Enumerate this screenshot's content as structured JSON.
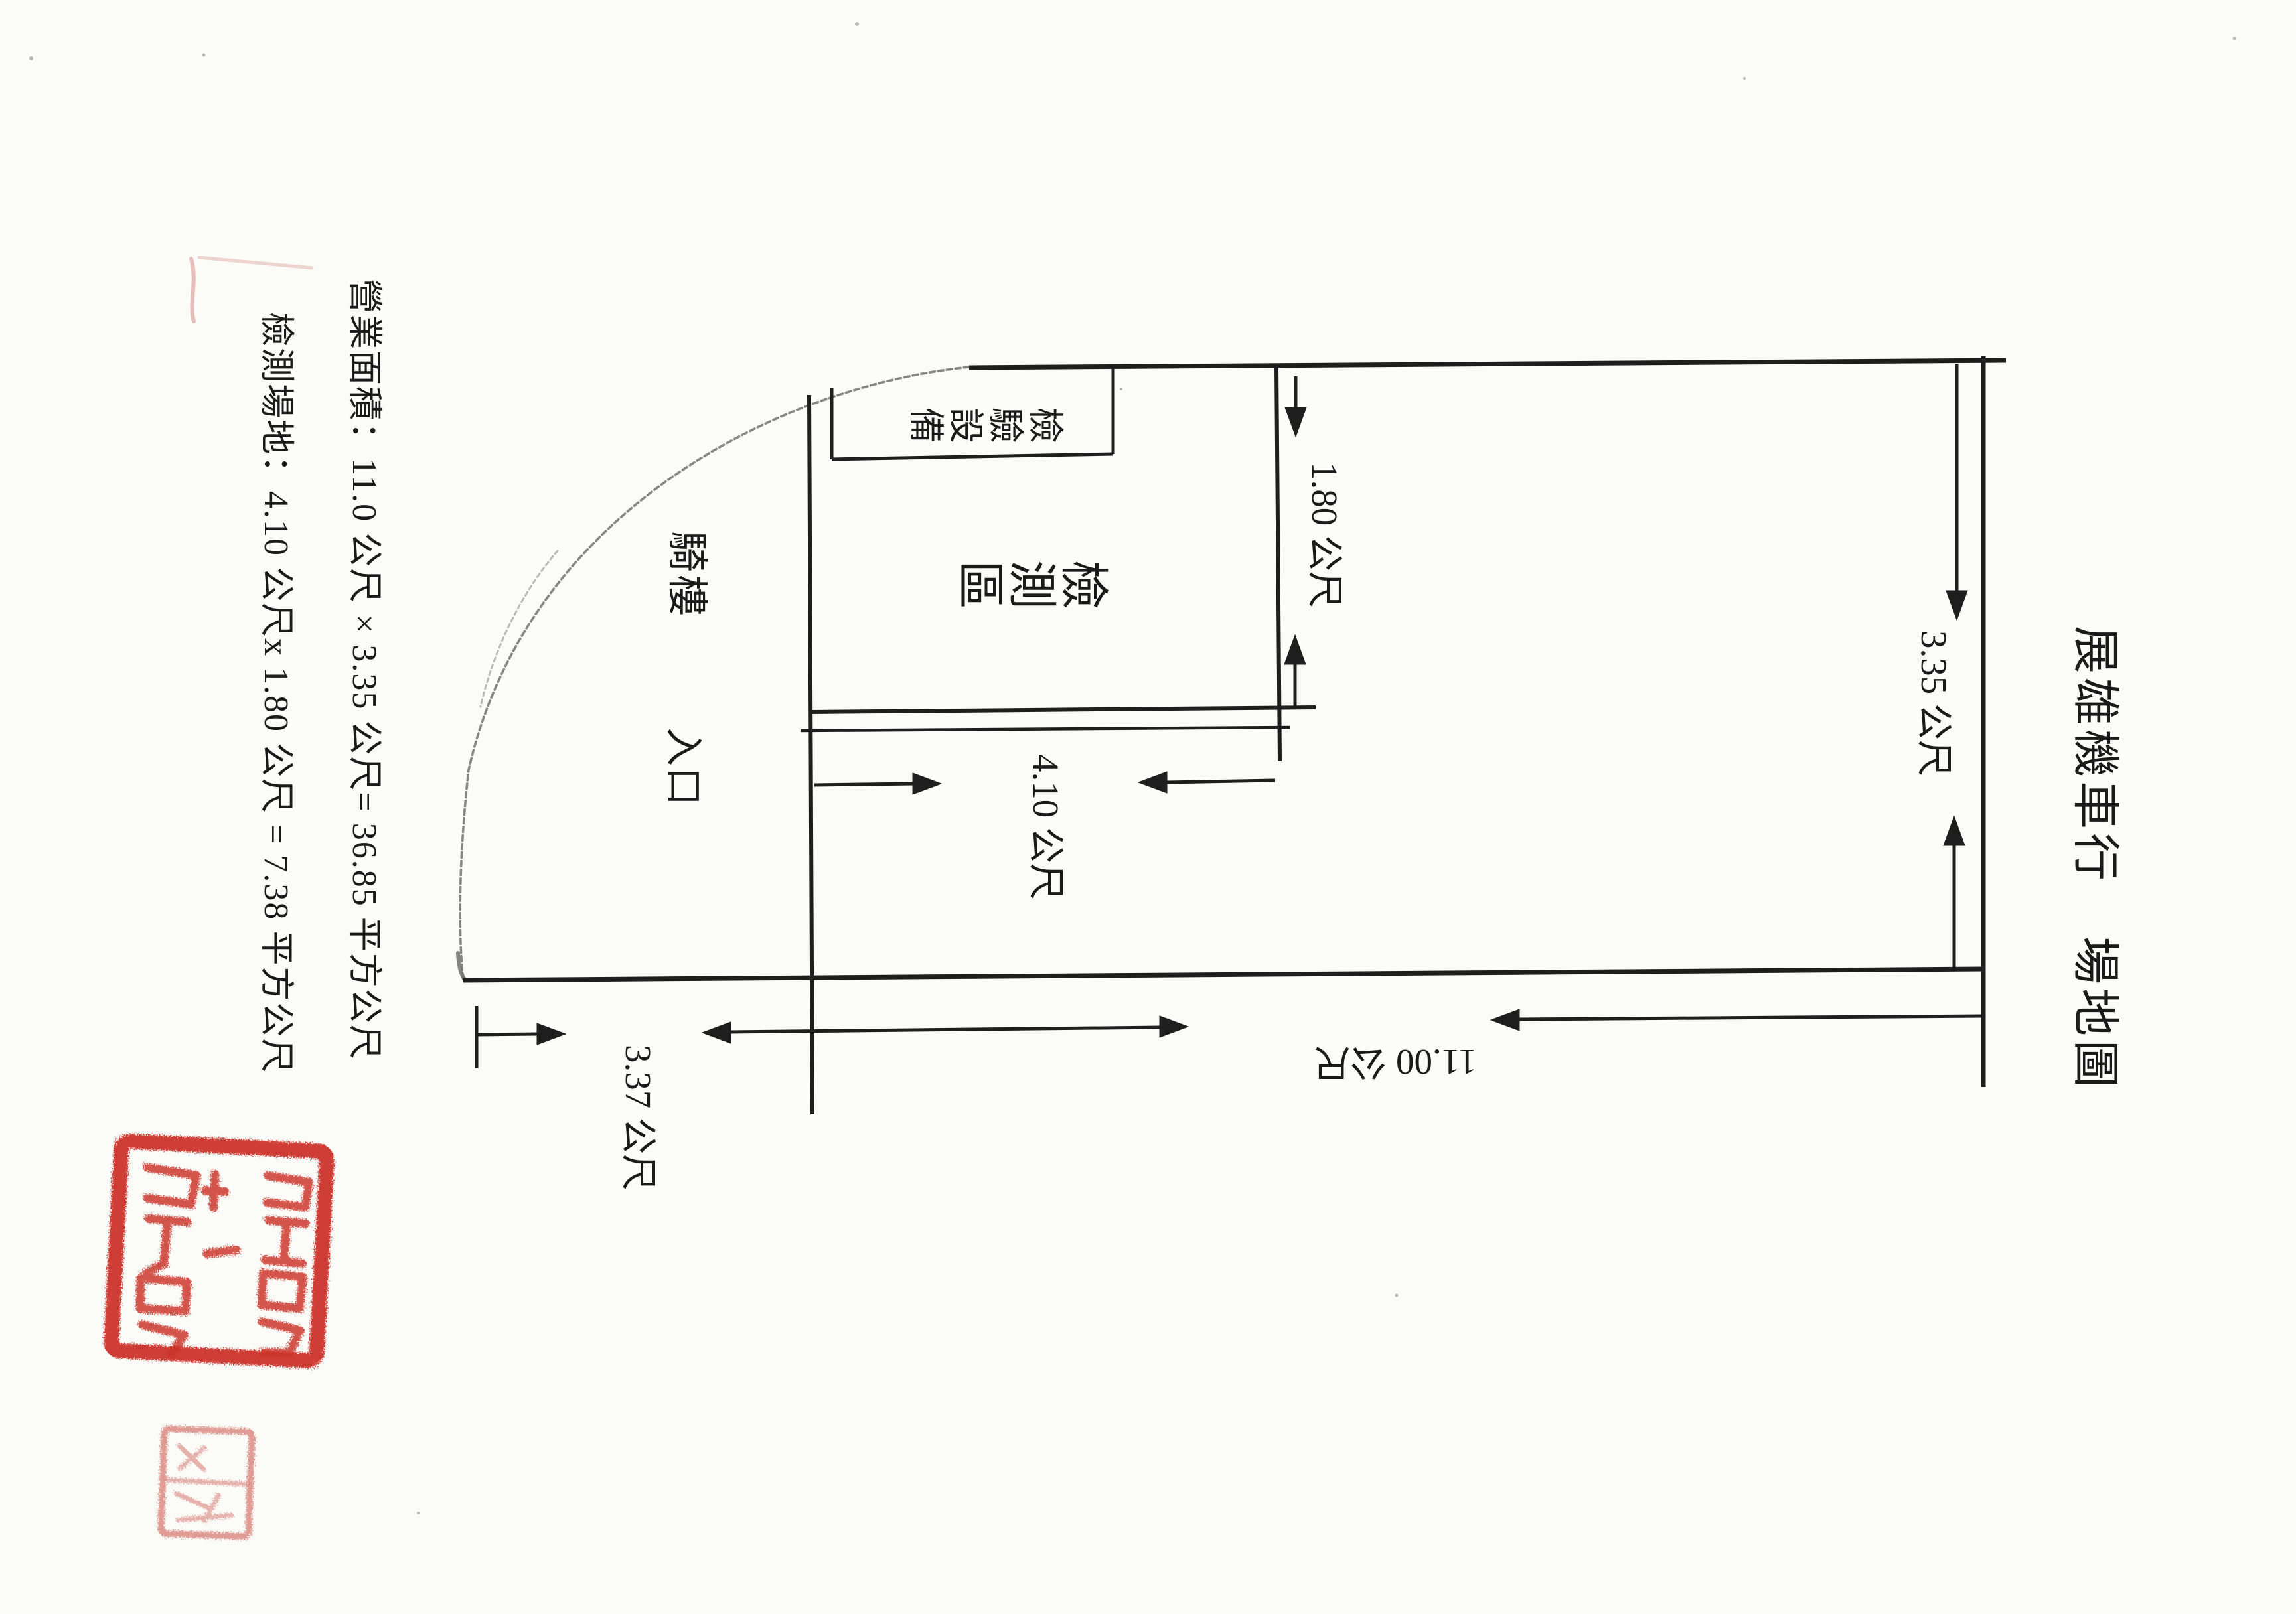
{
  "document": {
    "type": "scanned site-plan page",
    "title": "展雄機車行　場地圖"
  },
  "notes": {
    "business_area": "營業面積：11.0 公尺 × 3.35 公尺= 36.85 平方公尺",
    "test_site": "檢測場地：4.10 公尺x 1.80 公尺 = 7.38 平方公尺"
  },
  "labels": {
    "arcade": "騎樓",
    "entrance": "入口",
    "test_zone": "檢測區",
    "equipment": "檢驗設備"
  },
  "dimensions": {
    "test_depth": "1.80 公尺",
    "test_length": "4.10 公尺",
    "site_depth": "3.35 公尺",
    "arcade_width": "3.37 公尺",
    "site_length": "11.00 公尺"
  },
  "colors": {
    "paper": "#fbfbf7",
    "ink": "#1e1e1e",
    "pencil": "#878787",
    "seal_large": "#cb3127",
    "seal_small": "#d9827c"
  }
}
